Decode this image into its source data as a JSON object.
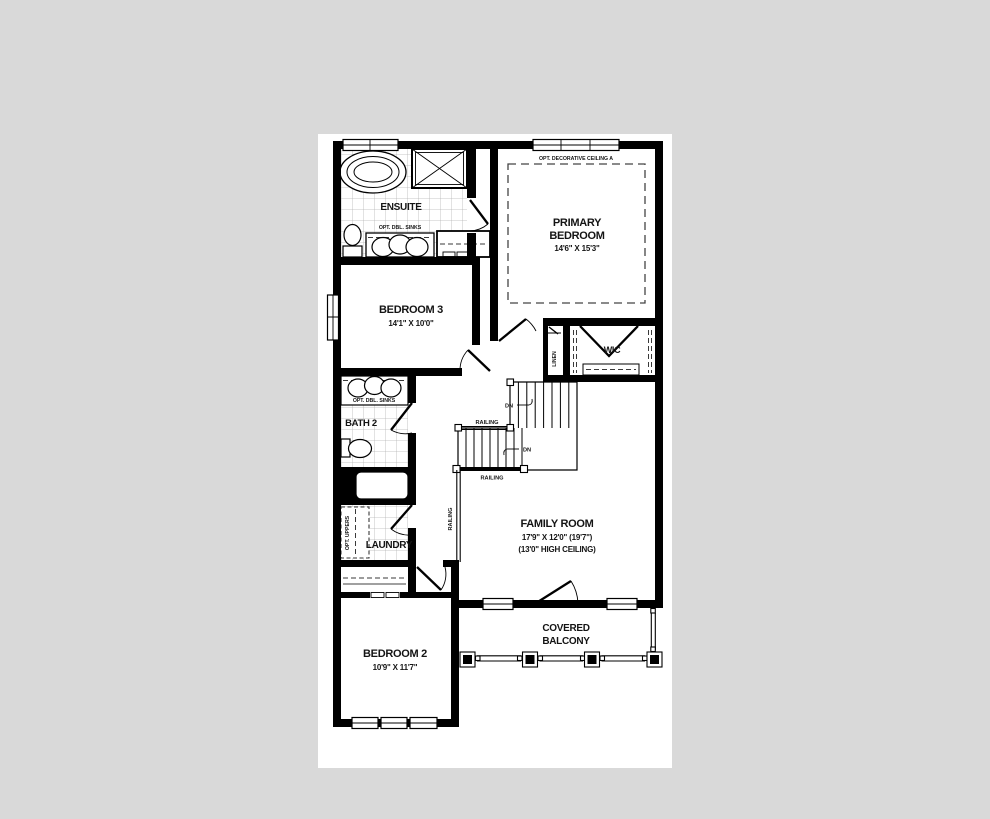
{
  "colors": {
    "page_background": "#d9d9d9",
    "paper": "#ffffff",
    "walls": "#000000",
    "tile_lines": "#b5b5b5",
    "dashed_lines": "#3a3a3a"
  },
  "rooms": {
    "ensuite": {
      "name": "ENSUITE",
      "sinks_note": "OPT. DBL. SINKS"
    },
    "primary_bedroom": {
      "name_line1": "PRIMARY",
      "name_line2": "BEDROOM",
      "dims": "14'6\" X 15'3\"",
      "ceiling_note": "OPT. DECORATIVE CEILING A"
    },
    "bedroom3": {
      "name": "BEDROOM 3",
      "dims": "14'1\" X 10'0\""
    },
    "wic": {
      "name": "WIC"
    },
    "linen": {
      "name": "LINEN"
    },
    "bath2": {
      "name": "BATH 2",
      "sinks_note": "OPT. DBL. SINKS"
    },
    "laundry": {
      "name": "LAUNDRY",
      "uppers_note": "OPT. UPPERS"
    },
    "family_room": {
      "name": "FAMILY ROOM",
      "dims": "17'9\" X 12'0\" (19'7\")",
      "ceiling_note": "(13'0\" HIGH CEILING)"
    },
    "bedroom2": {
      "name": "BEDROOM 2",
      "dims": "10'9\" X 11'7\""
    },
    "balcony": {
      "name_line1": "COVERED",
      "name_line2": "BALCONY"
    }
  },
  "stairs": {
    "down_label": "DN",
    "railing_label": "RAILING"
  }
}
